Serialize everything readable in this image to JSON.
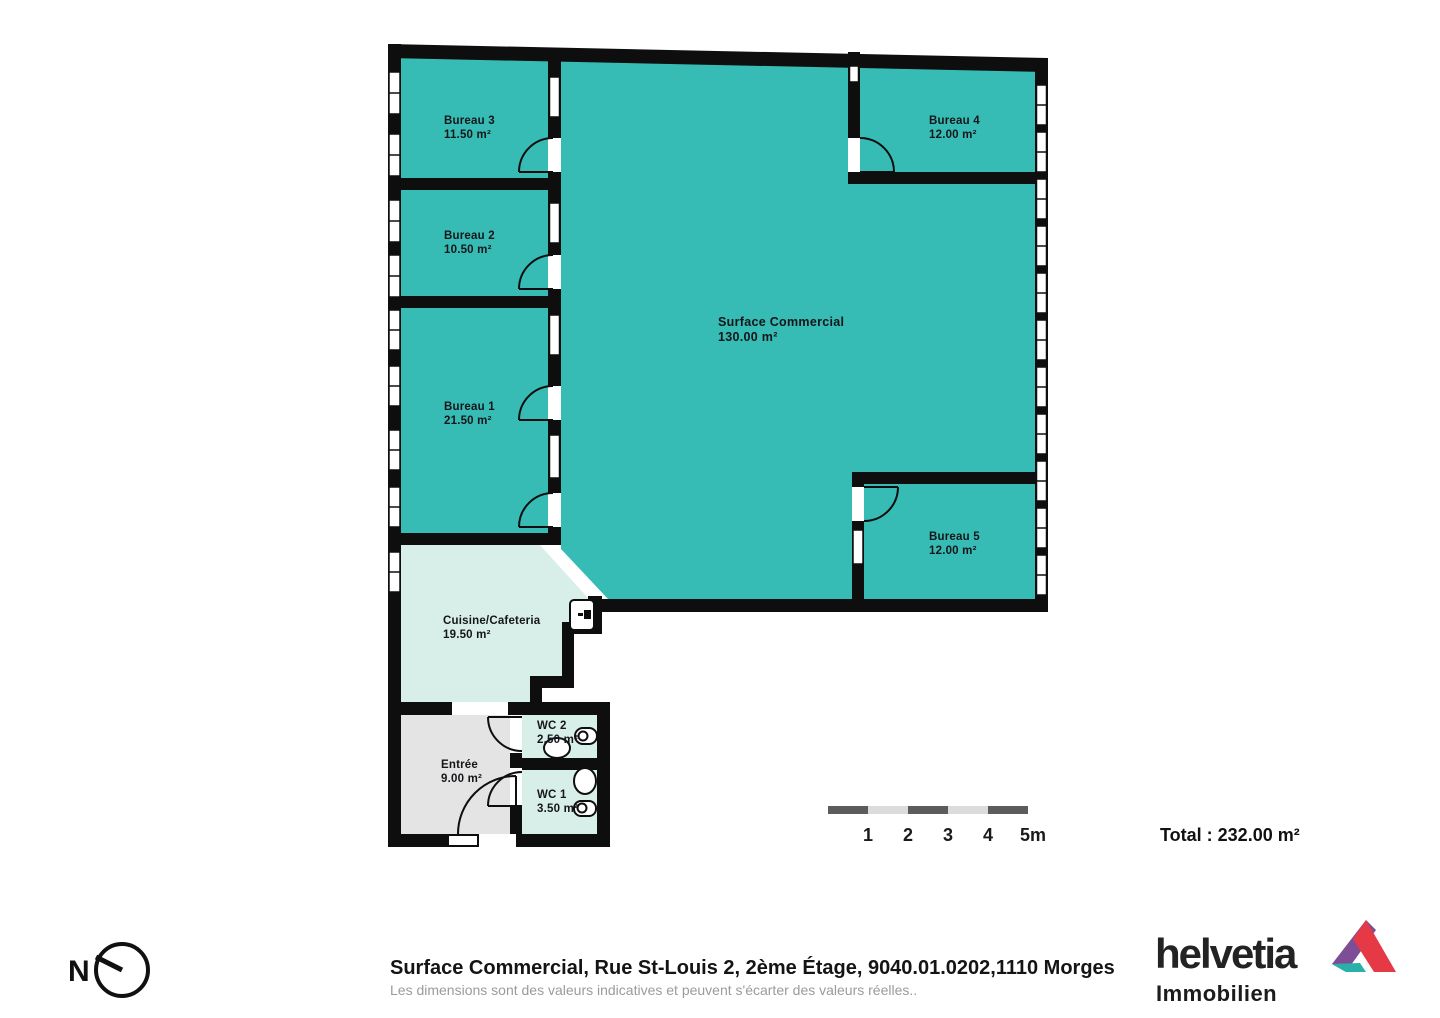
{
  "plan": {
    "rooms": {
      "bureau3": {
        "name": "Bureau 3",
        "area": "11.50 m²"
      },
      "bureau2": {
        "name": "Bureau 2",
        "area": "10.50 m²"
      },
      "bureau1": {
        "name": "Bureau 1",
        "area": "21.50 m²"
      },
      "bureau4": {
        "name": "Bureau 4",
        "area": "12.00 m²"
      },
      "bureau5": {
        "name": "Bureau 5",
        "area": "12.00 m²"
      },
      "surface": {
        "name": "Surface Commercial",
        "area": "130.00 m²"
      },
      "cuisine": {
        "name": "Cuisine/Cafeteria",
        "area": "19.50 m²"
      },
      "entree": {
        "name": "Entrée",
        "area": "9.00 m²"
      },
      "wc2": {
        "name": "WC 2",
        "area": "2.50 m²"
      },
      "wc1": {
        "name": "WC 1",
        "area": "3.50 m²"
      }
    },
    "colors": {
      "room_teal": "#36bcb4",
      "room_mint": "#d8efe9",
      "room_gray": "#e4e4e4",
      "wall": "#0e0e0e"
    }
  },
  "scale_bar": {
    "labels": [
      "1",
      "2",
      "3",
      "4",
      "5m"
    ],
    "dark": "#5c5c5c",
    "light": "#dcdcdc"
  },
  "total_label": "Total : 232.00 m²",
  "footer": {
    "address": "Surface Commercial, Rue St-Louis 2, 2ème Étage, 9040.01.0202,1110 Morges",
    "disclaimer": "Les dimensions sont des valeurs indicatives et peuvent s'écarter des valeurs réelles.."
  },
  "brand": {
    "name": "helvetia",
    "division": "Immobilien",
    "colors": {
      "purple": "#7d4e96",
      "red": "#e63946",
      "teal": "#29b0a8"
    }
  },
  "compass": {
    "label": "N"
  }
}
